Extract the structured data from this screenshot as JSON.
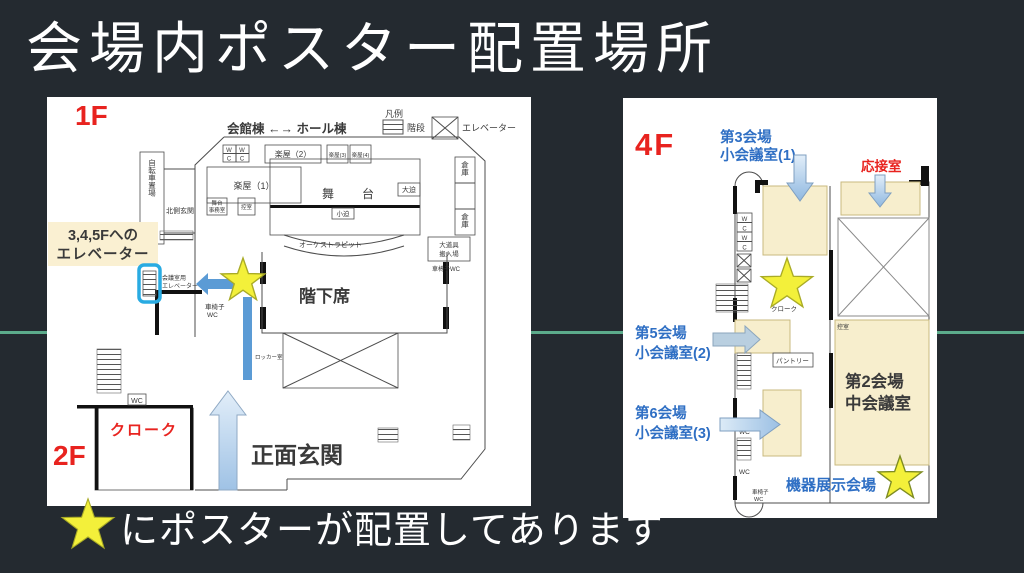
{
  "slide": {
    "title": "会場内ポスター配置場所",
    "footer": {
      "star": "★",
      "text": "にポスターが配置してあります"
    }
  },
  "colors": {
    "background": "#242a30",
    "divider_line": "#5cab8b",
    "panel": "#ffffff",
    "star_fill": "#f3f03a",
    "star_stroke": "#a9ab26",
    "red_label": "#e8231f",
    "blue_label": "#2f6fc4",
    "note_text": "#1f4e79",
    "note_background": "#faf0d2",
    "solid_arrow": "#5b9bd5",
    "room_highlight": "#f7eecd",
    "elevator_highlight": "#29abe2"
  },
  "left_plan": {
    "floor_top": "1F",
    "floor_bottom": "2F",
    "header": "会館棟 ←→ ホール棟",
    "legend": {
      "title": "凡例",
      "stairs": "階段",
      "elevator": "エレベーター"
    },
    "elevator_note": {
      "line1": "3,4,5Fへの",
      "line2": "エレベーター"
    },
    "map_elevator": {
      "line1": "会議室用",
      "line2": "エレベーター"
    },
    "entrance": "正面玄関",
    "cloak": "クローク",
    "rooms": {
      "bicycle": "自転車置場",
      "wc_letters": [
        "W",
        "C"
      ],
      "dressing1": "楽屋（1）",
      "dressing2": "楽屋（2）",
      "dressing3": "楽屋(3)",
      "dressing4": "楽屋(4)",
      "north_entrance": "北側玄関",
      "stage_office_l1": "舞台",
      "stage_office_l2": "事務室",
      "anteroom": "控室",
      "stage_char1": "舞",
      "stage_char2": "台",
      "small_lift": "小迫",
      "large_lift": "大迫",
      "storage": "倉庫",
      "orchestra_pit": "オーケストラピット",
      "lower_seats": "階下席",
      "props_l1": "大道具",
      "props_l2": "搬入場",
      "wheelchair_wc": "車椅子WC",
      "wheelchair_l1": "車椅子",
      "wheelchair_l2": "WC",
      "locker": "ロッカー室",
      "wc": "WC"
    }
  },
  "right_plan": {
    "floor": "4F",
    "venue3": {
      "line1": "第3会場",
      "line2": "小会議室(1)"
    },
    "reception": "応接室",
    "venue5": {
      "line1": "第5会場",
      "line2": "小会議室(2)"
    },
    "venue6": {
      "line1": "第6会場",
      "line2": "小会議室(3)"
    },
    "venue2": {
      "line1": "第2会場",
      "line2": "中会議室"
    },
    "exhibit": "機器展示会場",
    "rooms": {
      "cloak": "クローク",
      "anteroom": "控室",
      "pantry": "パントリー",
      "wc": "WC",
      "wheelchair_l1": "車椅子",
      "wheelchair_l2": "WC",
      "wc_letters": [
        "W",
        "C"
      ]
    }
  }
}
